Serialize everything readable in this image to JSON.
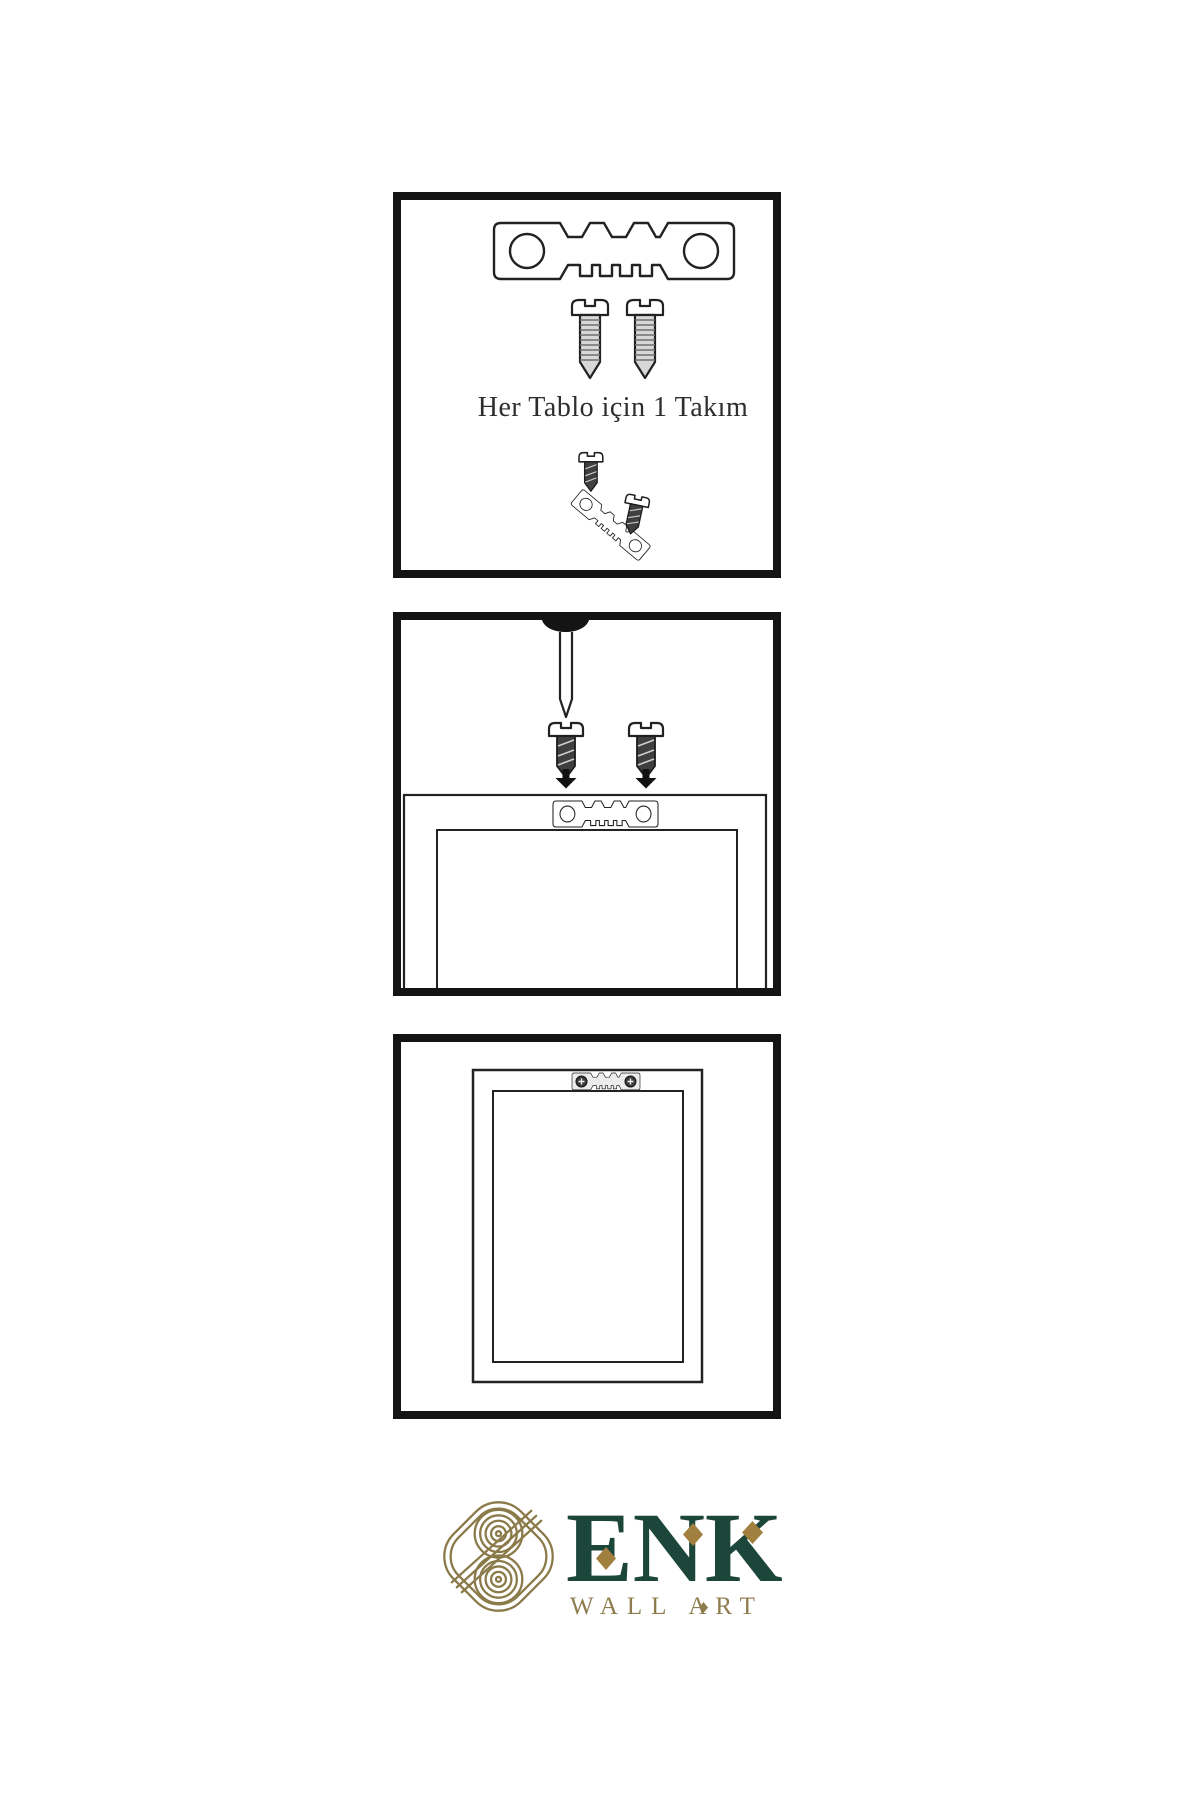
{
  "colors": {
    "background": "#ffffff",
    "line_ink": "#222222",
    "panel_border": "#141414",
    "screw_dark": "#3f3f3f",
    "screw_light": "#d8d8d8",
    "logo_green": "#1c463a",
    "logo_gold": "#8b7a49",
    "diamond_gold": "#a1803f"
  },
  "step1": {
    "caption": "Her Tablo için 1 Takım",
    "icons": [
      "sawtooth-hanger-icon",
      "screw-icon",
      "screw-icon",
      "screw-icon",
      "tilted-sawtooth-hanger-icon",
      "screw-icon"
    ]
  },
  "step2": {
    "icons": [
      "nail-icon",
      "screw-icon",
      "screw-icon",
      "arrow-down-icon",
      "arrow-down-icon",
      "sawtooth-hanger-icon",
      "frame-back-outline"
    ]
  },
  "step3": {
    "icons": [
      "picture-frame-outline",
      "mounted-sawtooth-hanger-icon"
    ]
  },
  "logo": {
    "title": "ENK",
    "subtitle": "WALL ART",
    "icons": [
      "knot-monogram-icon",
      "diamond-icon",
      "diamond-icon",
      "diamond-icon",
      "diamond-separator-icon"
    ]
  }
}
